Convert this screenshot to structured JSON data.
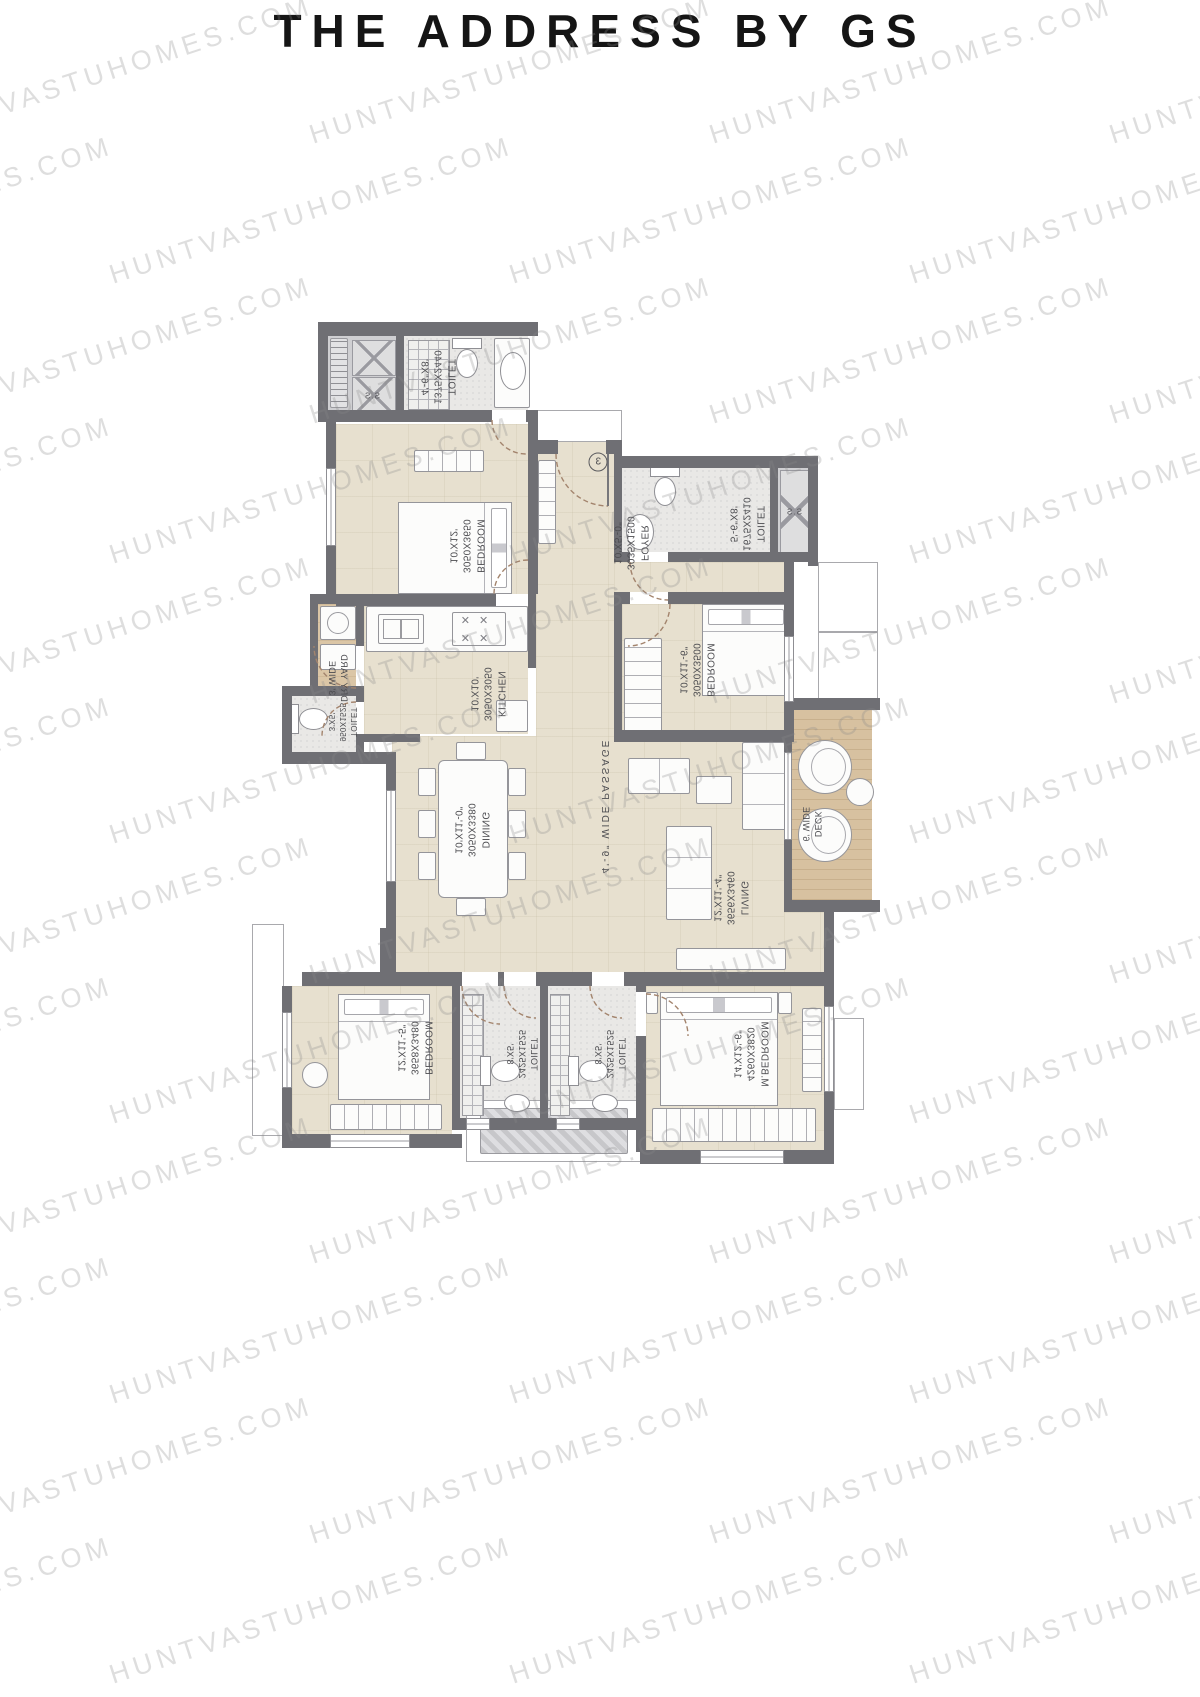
{
  "title": "THE ADDRESS BY GS",
  "watermark": {
    "text": "HUNTVASTUHOMES.COM"
  },
  "colors": {
    "wall": "#6f6f74",
    "floor": "#e7e0cf",
    "toilet_floor": "#e9e8e6",
    "deck_floor": "#d7c1a0",
    "dry_yard_floor": "#dbc6a6",
    "door_arc": "#a3846d",
    "watermark_text": "#8a8a8a",
    "title_text": "#151515",
    "label_text": "#4c4c50"
  },
  "plan": {
    "entrance_door_number": "3",
    "rooms": {
      "shaft1": {
        "name": "S.S"
      },
      "shaft2": {
        "name": "S.S"
      },
      "toilet1": {
        "name": "TOILET",
        "mm": "1375X2440",
        "ft": "4'-6\"X8'"
      },
      "bedroom1": {
        "name": "BEDROOM",
        "mm": "3050X3650",
        "ft": "10'X12'"
      },
      "foyer": {
        "name": "FOYER",
        "mm": "3035X1500",
        "ft": "10'X5'-0\""
      },
      "toilet2": {
        "name": "TOILET",
        "mm": "1675X2410",
        "ft": "5'-6\"X8'"
      },
      "bedroom2": {
        "name": "BEDROOM",
        "mm": "3050X3500",
        "ft": "10'X11'-6\""
      },
      "kitchen": {
        "name": "KITCHEN",
        "mm": "3050X3050",
        "ft": "10'X10'"
      },
      "dry_yard": {
        "name": "DRY YARD",
        "size": "3' WIDE"
      },
      "toilet3": {
        "name": "TOILET",
        "mm": "950X1525",
        "ft": "3'X5'"
      },
      "passage": {
        "name": "4'-9\" WIDE PASSAGE"
      },
      "dining": {
        "name": "DINING",
        "mm": "3050X3380",
        "ft": "10'X11'-0\""
      },
      "living": {
        "name": "LIVING",
        "mm": "3656X3460",
        "ft": "12'X11'-4\""
      },
      "deck": {
        "name": "DECK",
        "size": "6' WIDE"
      },
      "bedroom3": {
        "name": "BEDROOM",
        "mm": "3658X3480",
        "ft": "12'X11'-5\""
      },
      "toilet4": {
        "name": "TOILET",
        "mm": "2425X1525",
        "ft": "8'X5'"
      },
      "toilet5": {
        "name": "TOILET",
        "mm": "2425X1525",
        "ft": "8'X5'"
      },
      "master_bedroom": {
        "name": "M.BEDROOM",
        "mm": "4260X3820",
        "ft": "14'X12'-6\""
      }
    }
  }
}
